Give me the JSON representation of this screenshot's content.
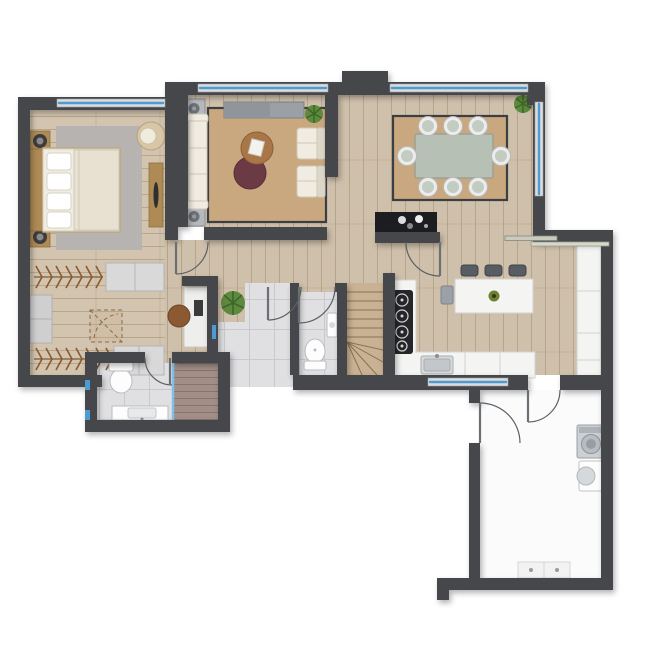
{
  "title": "apartment-floor-plan",
  "view": "top-down-2d-rendered-floor-plan",
  "colors": {
    "bg": "#ffffff",
    "wall": "#44474c",
    "window-glass": "#4e9ad3",
    "window-frame": "#dcdcdc",
    "wood-floor": "#cfc0ab",
    "rug-tan": "#c9a87f",
    "rug-gray": "#b7b3b0",
    "tile": "#e0e0e2",
    "shower-floor": "#a28e87",
    "laundry-floor": "#fbfbfc",
    "counter": "#f4f4f2",
    "dining-table-top": "#b7c0b4",
    "coffee-table-wood": "#a97747",
    "coffee-table-dark": "#6b3a44",
    "sideboard": "#1c1d20",
    "plant": "#5d8a3d",
    "furn-wood": "#ae8a55",
    "stairs": "#c9b193"
  },
  "rooms": [
    {
      "id": "bedroom",
      "floor": "wood",
      "furniture": [
        "double-bed",
        "headboard",
        "nightstand-x2",
        "table-lamp-x2",
        "area-rug",
        "tub-chair",
        "dresser-console"
      ]
    },
    {
      "id": "walk-in-closet",
      "floor": "wood",
      "furniture": [
        "hanging-rail-top",
        "hanging-rail-bottom",
        "shelf-units",
        "corner-unit-dashed"
      ]
    },
    {
      "id": "living-room",
      "floor": "wood",
      "furniture": [
        "sofa",
        "armchair-x2",
        "tv-console",
        "speaker-table-x2",
        "round-coffee-table-wood",
        "round-coffee-table-dark",
        "area-rug",
        "plant"
      ]
    },
    {
      "id": "dining-room",
      "floor": "wood",
      "furniture": [
        "dining-table",
        "dining-chair-x8",
        "area-rug",
        "black-sideboard",
        "plant"
      ]
    },
    {
      "id": "kitchen",
      "floor": "wood",
      "furniture": [
        "l-shaped-counter",
        "gas-hob",
        "sink",
        "island",
        "bar-stool-x3",
        "chair",
        "tall-cabinet-column",
        "plant-bowl"
      ]
    },
    {
      "id": "hallway",
      "floor": "wood",
      "furniture": [
        "desk",
        "desk-chair",
        "plant"
      ]
    },
    {
      "id": "entry",
      "floor": "gray-tile",
      "furniture": []
    },
    {
      "id": "wc",
      "floor": "gray-tile",
      "furniture": [
        "toilet",
        "washbasin"
      ]
    },
    {
      "id": "bathroom",
      "floor": "gray-tile",
      "furniture": [
        "toilet",
        "vanity-sink",
        "walk-in-shower",
        "glass-partition"
      ]
    },
    {
      "id": "staircase",
      "floor": "wood-treads",
      "furniture": [
        "straight-treads",
        "winder-treads"
      ]
    },
    {
      "id": "laundry-room",
      "floor": "white",
      "furniture": [
        "washing-machine",
        "dryer",
        "base-cabinet"
      ]
    }
  ],
  "counts": {
    "dining_chairs": 8,
    "bar_stools": 3,
    "plants": 4,
    "windows": 5,
    "swing_doors": 7,
    "sliding_doors": 1
  }
}
